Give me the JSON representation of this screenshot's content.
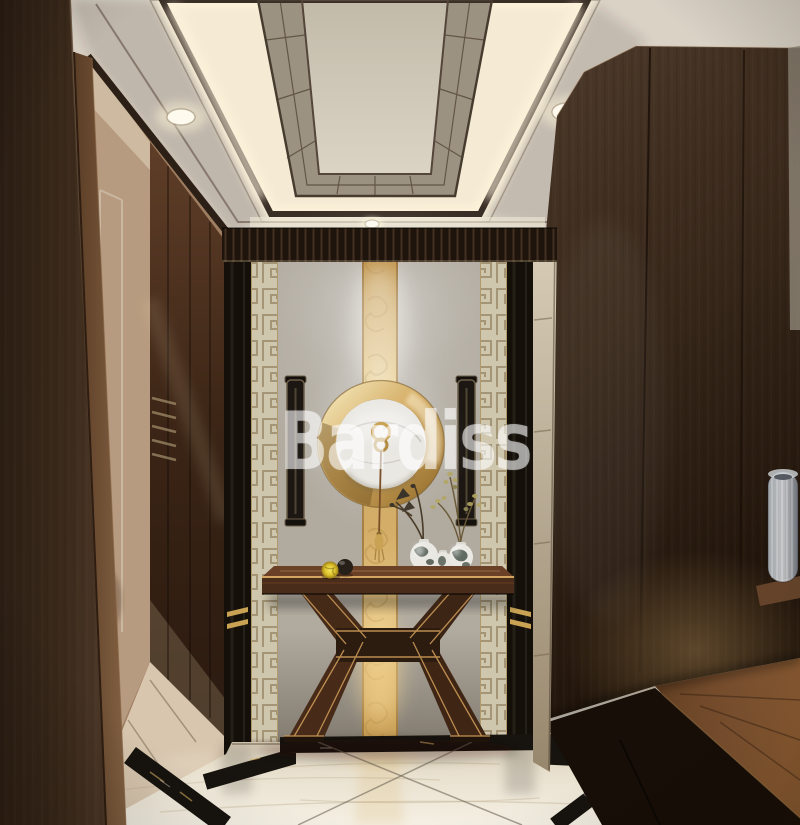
{
  "meta": {
    "type": "interior-design-rendering",
    "description": "New Chinese style entry hallway: tray ceiling with cove lighting, dark wood walls, grey stone feature wall with gold onyx strip and illuminated gold ring, console table with porcelain vases, cream marble floor with black stepped inlay",
    "width_px": 800,
    "height_px": 825
  },
  "watermark": {
    "text": "Bardiss"
  },
  "colors": {
    "dark-wood": "#332417",
    "wood-frame": "#6e5036",
    "ceiling-beige": "#d9d2c5",
    "cove-glow": "#f8efda",
    "panel-taupe": "#9c9282",
    "stone-wall": "#b2aca1",
    "fret-beige": "#cfc6ae",
    "fret-line": "#9e9070",
    "onyx-gold": "#d9b872",
    "ring-gold": "#c89a4e",
    "marble-disc": "#eae8e3",
    "floor-marble": "#ece4d2",
    "inlay-black": "#17130e",
    "table-wood": "#4e2f1d",
    "trim-gold": "#c49455",
    "porcelain-white": "#e9e8e2",
    "watermark-white": "rgba(255,255,255,0.55)"
  },
  "scene": {
    "objects": [
      {
        "name": "tray-ceiling",
        "desc": "coffered tray ceiling with warm cove lighting, taupe sloped panels and recessed downlights"
      },
      {
        "name": "left-wood-wall",
        "desc": "dark walnut panel wall with door casing"
      },
      {
        "name": "doorway",
        "desc": "open doorway with bronze mirror panels leading to adjacent room"
      },
      {
        "name": "feature-wall",
        "desc": "grey stone feature wall with greek-key borders and vertical gold onyx strip"
      },
      {
        "name": "ring-light",
        "desc": "illuminated gold ring with white marble disc and hanging gold ornament with tassel"
      },
      {
        "name": "console-table",
        "desc": "dark wood console table with gold pinstripe X legs"
      },
      {
        "name": "vases",
        "desc": "three porcelain vases with branches"
      },
      {
        "name": "decor-spheres",
        "desc": "yellow and black decorative spheres"
      },
      {
        "name": "wardrobe",
        "desc": "floor-to-ceiling dark wood wardrobe wall with low wood bench cabinet and ribbed glass vessel"
      },
      {
        "name": "marble-floor",
        "desc": "cream marble floor with black marble stepped inlay and diagonal joint lines"
      }
    ]
  }
}
